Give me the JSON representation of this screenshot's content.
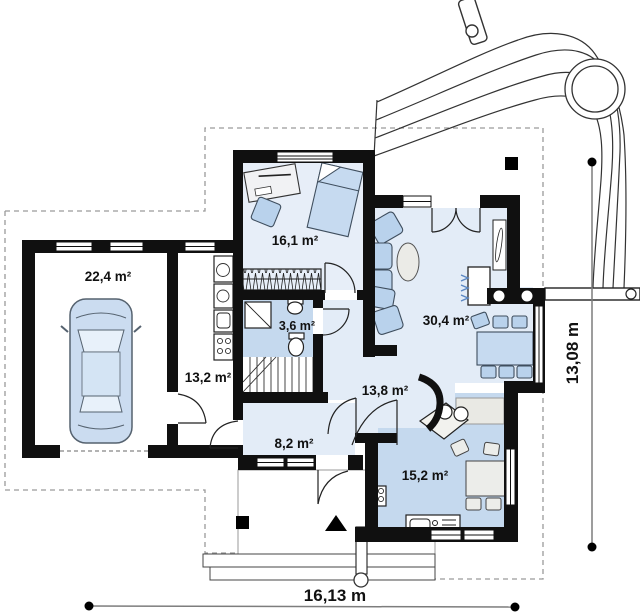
{
  "plan": {
    "type": "house-floor-plan",
    "rooms": [
      {
        "id": "garage",
        "area_label": "22,4 m²"
      },
      {
        "id": "utility",
        "area_label": "13,2 m²"
      },
      {
        "id": "study",
        "area_label": "16,1 m²"
      },
      {
        "id": "bathroom",
        "area_label": "3,6 m²"
      },
      {
        "id": "hall",
        "area_label": "13,8 m²"
      },
      {
        "id": "vestibule",
        "area_label": "8,2 m²"
      },
      {
        "id": "living_room",
        "area_label": "30,4 m²"
      },
      {
        "id": "kitchen",
        "area_label": "15,2 m²"
      }
    ],
    "dimensions": {
      "width_label": "16,13 m",
      "height_label": "13,08 m"
    },
    "colors": {
      "wall": "#101010",
      "floor_light": "#e3ecf7",
      "floor_study": "#e7eef8",
      "floor_shaded": "#c5d9ee",
      "furniture_blue": "#b9d2ec",
      "furniture_gray": "#ecedea",
      "boundary_dash": "#9a9a9a"
    },
    "icons": {
      "entrance_marker": "north-arrow-triangle",
      "site_marker": "black-square",
      "drain": "small-circle",
      "driveway": "curved-line-band"
    }
  }
}
